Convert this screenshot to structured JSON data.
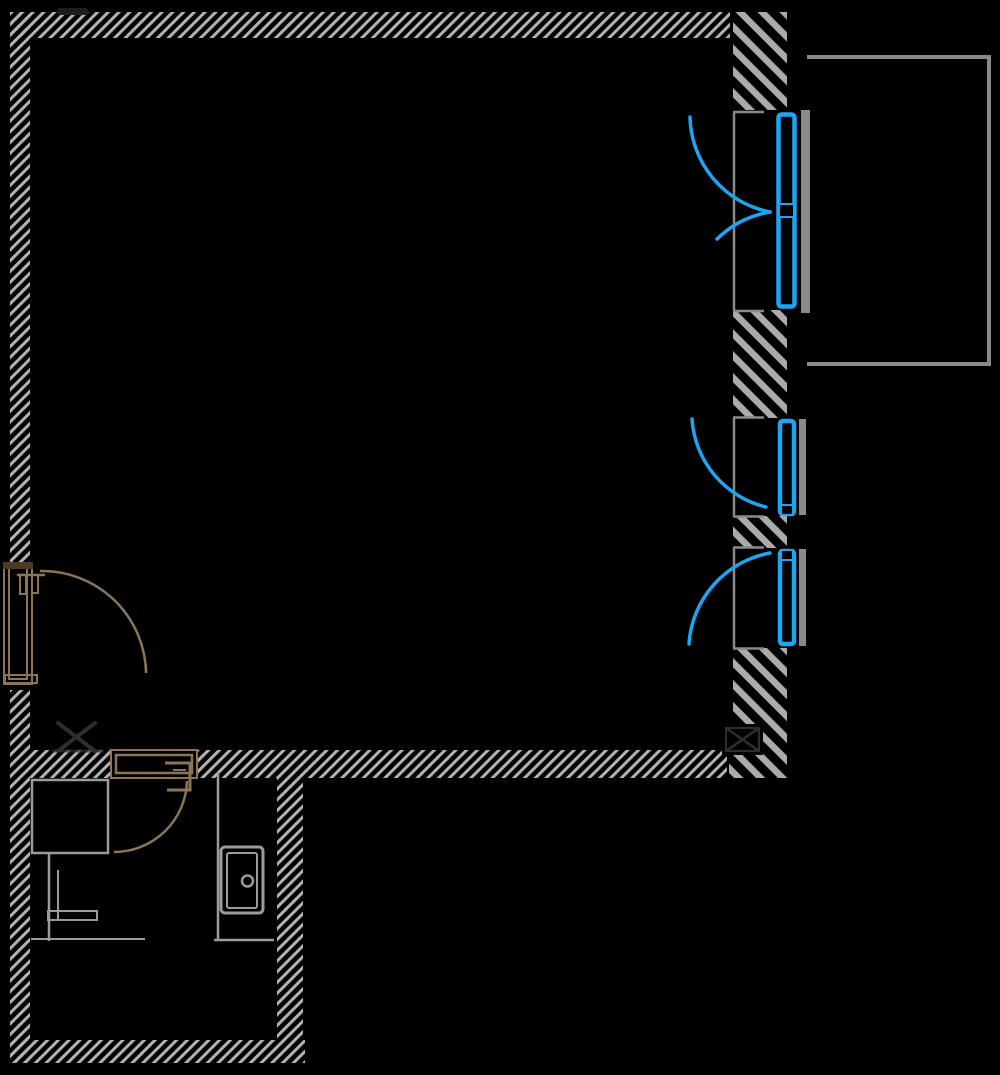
{
  "canvas": {
    "width": 1000,
    "height": 1075,
    "background": "#000000"
  },
  "colors": {
    "hatch_fine": "#b3b3b3",
    "hatch_coarse": "#ababab",
    "door_blue": "#1ba5f2",
    "wood": "#8c7454",
    "wood_dark": "#4a3b28",
    "frame_gray": "#8a8a8a",
    "fixture_gray": "#9b9b9b",
    "marker_dark": "#2e2e2e",
    "artifact_dark": "#1d1d1d"
  },
  "plan": {
    "rooms": [
      {
        "name": "main-room"
      },
      {
        "name": "bathroom"
      },
      {
        "name": "balcony"
      }
    ],
    "doors_windows": [
      {
        "name": "french-window-top-right",
        "color_key": "door_blue",
        "leaves": 2
      },
      {
        "name": "window-middle-right",
        "color_key": "door_blue",
        "leaves": 1
      },
      {
        "name": "window-lower-right",
        "color_key": "door_blue",
        "leaves": 1
      },
      {
        "name": "entry-door-left",
        "color_key": "wood",
        "leaves": 1
      },
      {
        "name": "bathroom-door",
        "color_key": "wood",
        "leaves": 1
      }
    ],
    "fixtures": [
      {
        "name": "shower-tray-square"
      },
      {
        "name": "washbasin-pedestal"
      },
      {
        "name": "appliance-with-knob"
      }
    ],
    "markers": [
      {
        "name": "x-marker-left"
      },
      {
        "name": "x-box-duct-right"
      }
    ]
  }
}
